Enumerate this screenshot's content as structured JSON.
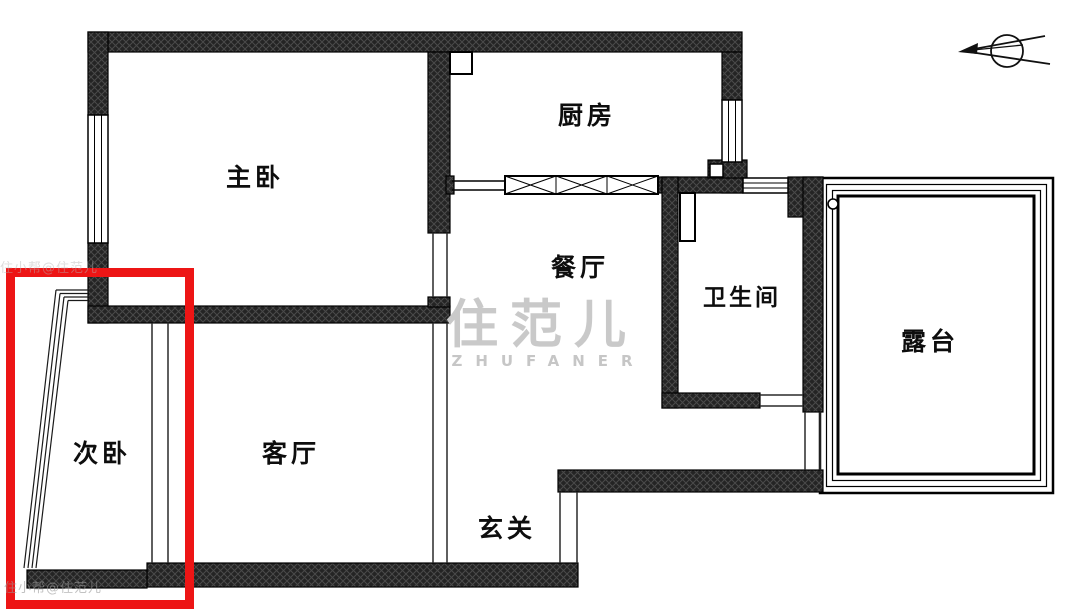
{
  "page": {
    "type": "apartment-floor-plan"
  },
  "rooms": {
    "master_bedroom": {
      "label": "主卧"
    },
    "kitchen": {
      "label": "厨房"
    },
    "dining_room": {
      "label": "餐厅"
    },
    "bathroom": {
      "label": "卫生间"
    },
    "terrace": {
      "label": "露台"
    },
    "second_bedroom": {
      "label": "次卧"
    },
    "living_room": {
      "label": "客厅"
    },
    "entryway": {
      "label": "玄关"
    }
  },
  "watermark": {
    "logo_text": "住范儿",
    "brand_text": "ZHUFANER",
    "corner_text": "住小帮@住范儿"
  },
  "highlight": {
    "target_room": "次卧",
    "color": "#ed1515"
  },
  "colors": {
    "wall": "#242424",
    "hatch": "#4a4a4a",
    "line": "#1a1a1a",
    "background": "#ffffff",
    "watermark_gray": "#c9c9c9"
  }
}
